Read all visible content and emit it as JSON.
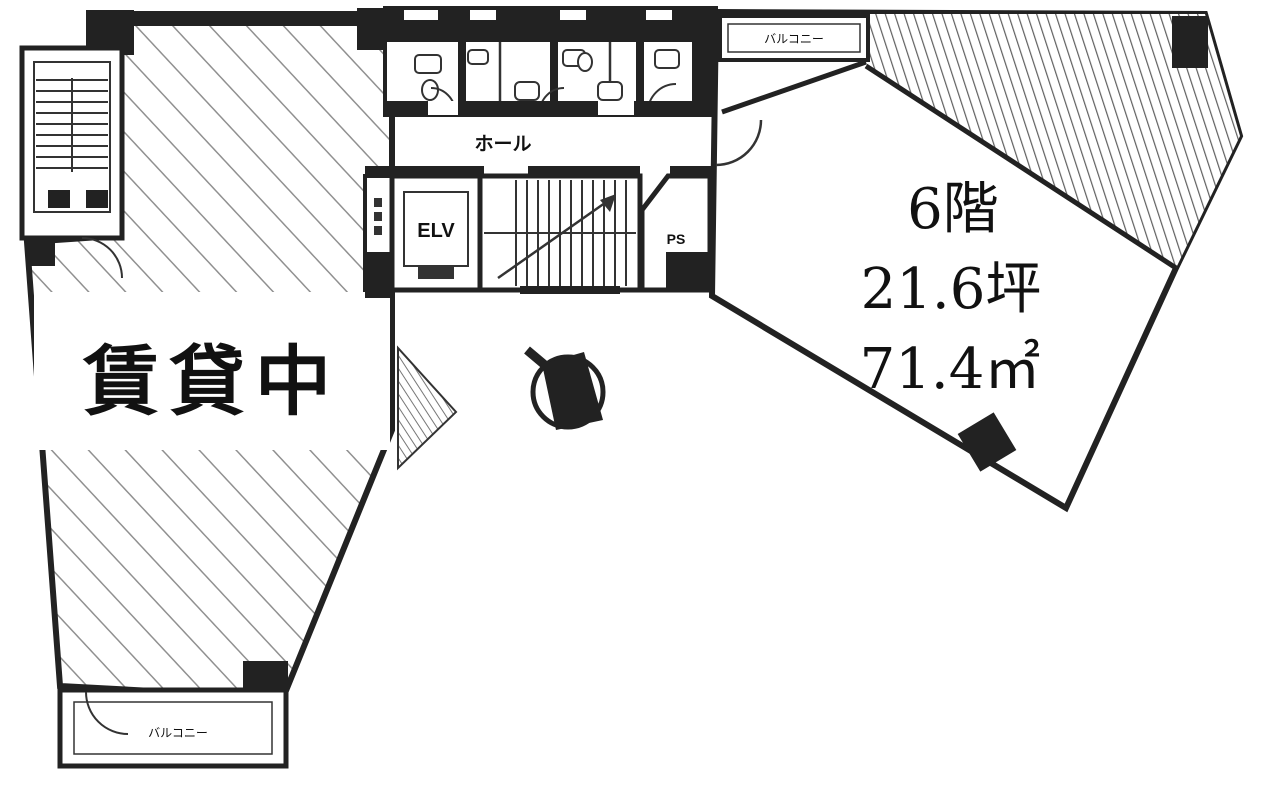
{
  "plan": {
    "left_unit": {
      "label": "賃貸中"
    },
    "right_unit": {
      "floor_label": "6階",
      "tsubo_label": "21.6坪",
      "area_label": "71.4㎡"
    },
    "core": {
      "hall_label": "ホール",
      "elevator_label": "ELV",
      "pipe_shaft_label": "PS"
    },
    "balconies": {
      "top_label": "バルコニー",
      "bottom_label": "バルコニー"
    },
    "icons": {
      "compass": "north-compass-icon"
    },
    "colors": {
      "wall": "#222222",
      "hatch_left": "#909090",
      "hatch_right": "#606060",
      "background": "#ffffff"
    }
  }
}
